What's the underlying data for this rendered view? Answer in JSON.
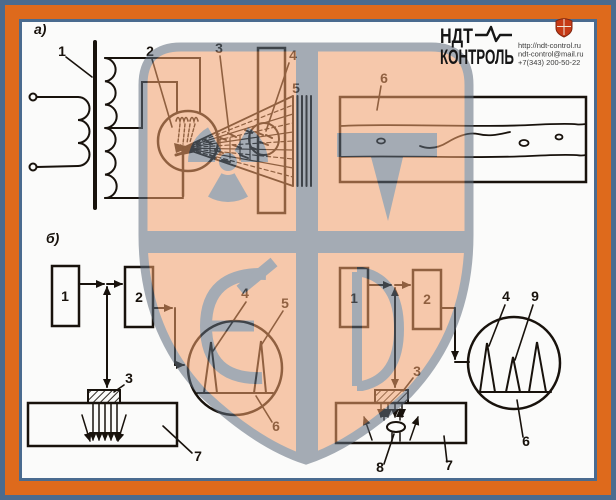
{
  "figure": {
    "caption_a": "а)",
    "caption_b": "б)",
    "xray": {
      "l1": "1",
      "l2": "2",
      "l3": "3",
      "l4": "4",
      "l5": "5",
      "l6": "6"
    },
    "echo_clean": {
      "l1": "1",
      "l2": "2",
      "l3": "3",
      "l4": "4",
      "l5": "5",
      "l6": "6",
      "l7": "7"
    },
    "echo_defect": {
      "l1": "1",
      "l2": "2",
      "l3": "3",
      "l4": "4",
      "l6": "6",
      "l7": "7",
      "l8": "8",
      "l9": "9"
    }
  },
  "logo": {
    "name_line1": "НДТ",
    "name_line2": "КОНТРОЛЬ",
    "website": "http://ndt-control.ru",
    "email": "ndt-control@mail.ru",
    "phone": "+7(343) 200-50-22"
  },
  "colors": {
    "frame_orange": "#DE6A1C",
    "frame_slate": "#4A6B8F",
    "panel_white": "#FBFBFA",
    "ink": "#18120c",
    "watermark_orange": "#F2A06B",
    "watermark_gray": "#5E6B7B",
    "logo_shield_red": "#C63A16"
  }
}
